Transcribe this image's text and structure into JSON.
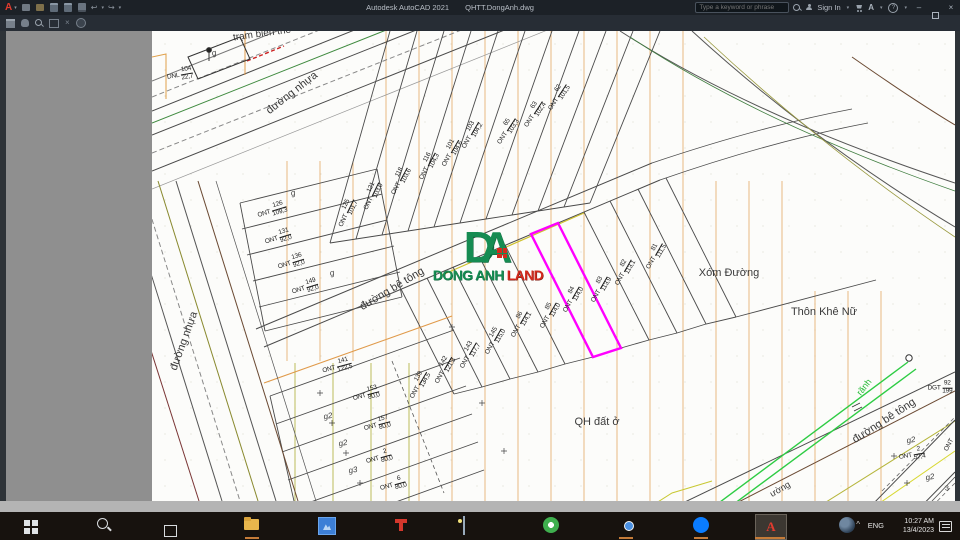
{
  "titlebar": {
    "app_logo": "A",
    "app_title": "Autodesk AutoCAD 2021",
    "doc_title": "QHTT.DongAnh.dwg",
    "search_placeholder": "Type a keyword or phrase",
    "sign_in": "Sign In",
    "help_glyph": "?",
    "minimize_glyph": "–",
    "close_glyph": "×",
    "left_icons": [
      "new-file-icon",
      "open-folder-icon",
      "save-icon",
      "save-as-icon",
      "print-icon",
      "undo-icon",
      "redo-icon"
    ],
    "undo_glyph": "↩",
    "redo_glyph": "↪"
  },
  "ribbon": {
    "icons": [
      "print-icon",
      "pan-hand-icon",
      "zoom-magnifier-icon",
      "viewport-frame-icon",
      "erase-icon",
      "help-circle-icon"
    ]
  },
  "logo": {
    "letter_d": "D",
    "letter_a": "A",
    "word1": "DONG ANH",
    "word2": "LAND",
    "green": "#168c52",
    "red": "#d32b1e"
  },
  "canvas": {
    "highlight_color": "#ff00ff",
    "hatch_color": "#e09a4a",
    "canal_color": "#2ecc44",
    "area_labels": [
      {
        "text": "trạm biến thế",
        "x": 110,
        "y": 3,
        "rot": -8,
        "size": 10
      },
      {
        "text": "đường nhựa",
        "x": 140,
        "y": 62,
        "rot": -38,
        "size": 11
      },
      {
        "text": "đường nhựa",
        "x": 32,
        "y": 310,
        "rot": -70,
        "size": 11
      },
      {
        "text": "đường bê tông",
        "x": 240,
        "y": 258,
        "rot": -31,
        "size": 11
      },
      {
        "text": "đường bê tông",
        "x": 732,
        "y": 390,
        "rot": -33,
        "size": 11
      },
      {
        "text": "Xóm Đường",
        "x": 577,
        "y": 242,
        "rot": 0,
        "size": 11
      },
      {
        "text": "Thôn Khê Nữ",
        "x": 672,
        "y": 281,
        "rot": 0,
        "size": 11
      },
      {
        "text": "QH đất ở",
        "x": 445,
        "y": 391,
        "rot": 0,
        "size": 11
      },
      {
        "text": "rãnh",
        "x": 712,
        "y": 356,
        "rot": -52,
        "size": 9,
        "color": "#22bb33"
      },
      {
        "text": "ường",
        "x": 628,
        "y": 458,
        "rot": -30,
        "size": 9
      },
      {
        "text": "g",
        "x": 62,
        "y": 22,
        "rot": -15,
        "size": 8,
        "italic": true
      },
      {
        "text": "g",
        "x": 141,
        "y": 162,
        "rot": -15,
        "size": 8,
        "italic": true
      },
      {
        "text": "g",
        "x": 180,
        "y": 242,
        "rot": -15,
        "size": 8,
        "italic": true
      },
      {
        "text": "g2",
        "x": 176,
        "y": 385,
        "rot": -10,
        "size": 8,
        "italic": true
      },
      {
        "text": "g2",
        "x": 191,
        "y": 412,
        "rot": -10,
        "size": 8,
        "italic": true
      },
      {
        "text": "g3",
        "x": 201,
        "y": 439,
        "rot": -10,
        "size": 8,
        "italic": true
      },
      {
        "text": "g2",
        "x": 759,
        "y": 409,
        "rot": -10,
        "size": 8,
        "italic": true
      },
      {
        "text": "g2",
        "x": 778,
        "y": 446,
        "rot": -10,
        "size": 8,
        "italic": true
      },
      {
        "text": "3",
        "x": 795,
        "y": 458,
        "rot": 0,
        "size": 7
      }
    ],
    "plot_labels": [
      {
        "p": "ONT",
        "n": "62",
        "d": "101,5",
        "x": 406,
        "y": 66,
        "r": -57
      },
      {
        "p": "ONT",
        "n": "63",
        "d": "102,4",
        "x": 382,
        "y": 83,
        "r": -57
      },
      {
        "p": "ONT",
        "n": "65",
        "d": "103,3",
        "x": 355,
        "y": 100,
        "r": -57
      },
      {
        "p": "ONT",
        "n": "103",
        "d": "104,2",
        "x": 319,
        "y": 104,
        "r": -60
      },
      {
        "p": "ONT",
        "n": "101",
        "d": "104,6",
        "x": 299,
        "y": 122,
        "r": -60
      },
      {
        "p": "ONT",
        "n": "116",
        "d": "104,3",
        "x": 276,
        "y": 135,
        "r": -62
      },
      {
        "p": "ONT",
        "n": "118",
        "d": "103,6",
        "x": 248,
        "y": 150,
        "r": -62
      },
      {
        "p": "ONT",
        "n": "121",
        "d": "103,0",
        "x": 220,
        "y": 165,
        "r": -64
      },
      {
        "p": "ONT",
        "n": "125",
        "d": "101,7",
        "x": 195,
        "y": 182,
        "r": -64
      },
      {
        "p": "ONT",
        "n": "126",
        "d": "109,3",
        "x": 120,
        "y": 180,
        "r": -17
      },
      {
        "p": "ONT",
        "n": "131",
        "d": "92,0",
        "x": 126,
        "y": 207,
        "r": -17
      },
      {
        "p": "ONT",
        "n": "136",
        "d": "92,0",
        "x": 139,
        "y": 232,
        "r": -17
      },
      {
        "p": "ONT",
        "n": "149",
        "d": "92,0",
        "x": 153,
        "y": 257,
        "r": -17
      },
      {
        "p": "ONT",
        "n": "81",
        "d": "111,5",
        "x": 503,
        "y": 225,
        "r": -60
      },
      {
        "p": "ONT",
        "n": "82",
        "d": "113,1",
        "x": 472,
        "y": 241,
        "r": -60
      },
      {
        "p": "ONT",
        "n": "83",
        "d": "113,9",
        "x": 448,
        "y": 258,
        "r": -60
      },
      {
        "p": "ONT",
        "n": "84",
        "d": "114,0",
        "x": 420,
        "y": 268,
        "r": -60
      },
      {
        "p": "ONT",
        "n": "85",
        "d": "114,0",
        "x": 397,
        "y": 284,
        "r": -60
      },
      {
        "p": "ONT",
        "n": "86",
        "d": "114,1",
        "x": 368,
        "y": 293,
        "r": -60
      },
      {
        "p": "ONT",
        "n": "145",
        "d": "115,0",
        "x": 342,
        "y": 310,
        "r": -60
      },
      {
        "p": "ONT",
        "n": "143",
        "d": "117,7",
        "x": 317,
        "y": 324,
        "r": -60
      },
      {
        "p": "ONT",
        "n": "142",
        "d": "121,3",
        "x": 292,
        "y": 339,
        "r": -60
      },
      {
        "p": "ONT",
        "n": "139",
        "d": "134,5",
        "x": 267,
        "y": 354,
        "r": -60
      },
      {
        "p": "ONT",
        "n": "141",
        "d": "122,5",
        "x": 185,
        "y": 336,
        "r": -15
      },
      {
        "p": "ONT",
        "n": "153",
        "d": "80,0",
        "x": 214,
        "y": 364,
        "r": -15
      },
      {
        "p": "ONT",
        "n": "157",
        "d": "80,0",
        "x": 225,
        "y": 394,
        "r": -15
      },
      {
        "p": "ONT",
        "n": "2",
        "d": "80,0",
        "x": 227,
        "y": 427,
        "r": -15
      },
      {
        "p": "ONT",
        "n": "6",
        "d": "80,0",
        "x": 241,
        "y": 454,
        "r": -15
      },
      {
        "p": "DNL",
        "n": "104",
        "d": "22,7",
        "x": 28,
        "y": 44,
        "r": -10
      },
      {
        "p": "DGT",
        "n": "92",
        "d": "199",
        "x": 788,
        "y": 357,
        "r": 0
      },
      {
        "p": "ONT",
        "n": "2",
        "d": "57,4",
        "x": 760,
        "y": 424,
        "r": -10
      },
      {
        "p": "ONT",
        "n": "",
        "d": "",
        "x": 797,
        "y": 414,
        "r": -62
      }
    ]
  },
  "taskbar": {
    "icons": [
      "start-icon",
      "search-icon",
      "task-view-icon",
      "file-explorer-icon",
      "photos-app-icon",
      "red-white-app-icon",
      "picture-app-icon",
      "green-ring-app-icon",
      "chrome-icon",
      "zalo-icon",
      "autocad-icon",
      "google-earth-icon"
    ],
    "acad_letter": "A",
    "tray": {
      "chevron": "^",
      "lang": "ENG",
      "time": "10:27 AM",
      "date": "13/4/2023"
    }
  }
}
